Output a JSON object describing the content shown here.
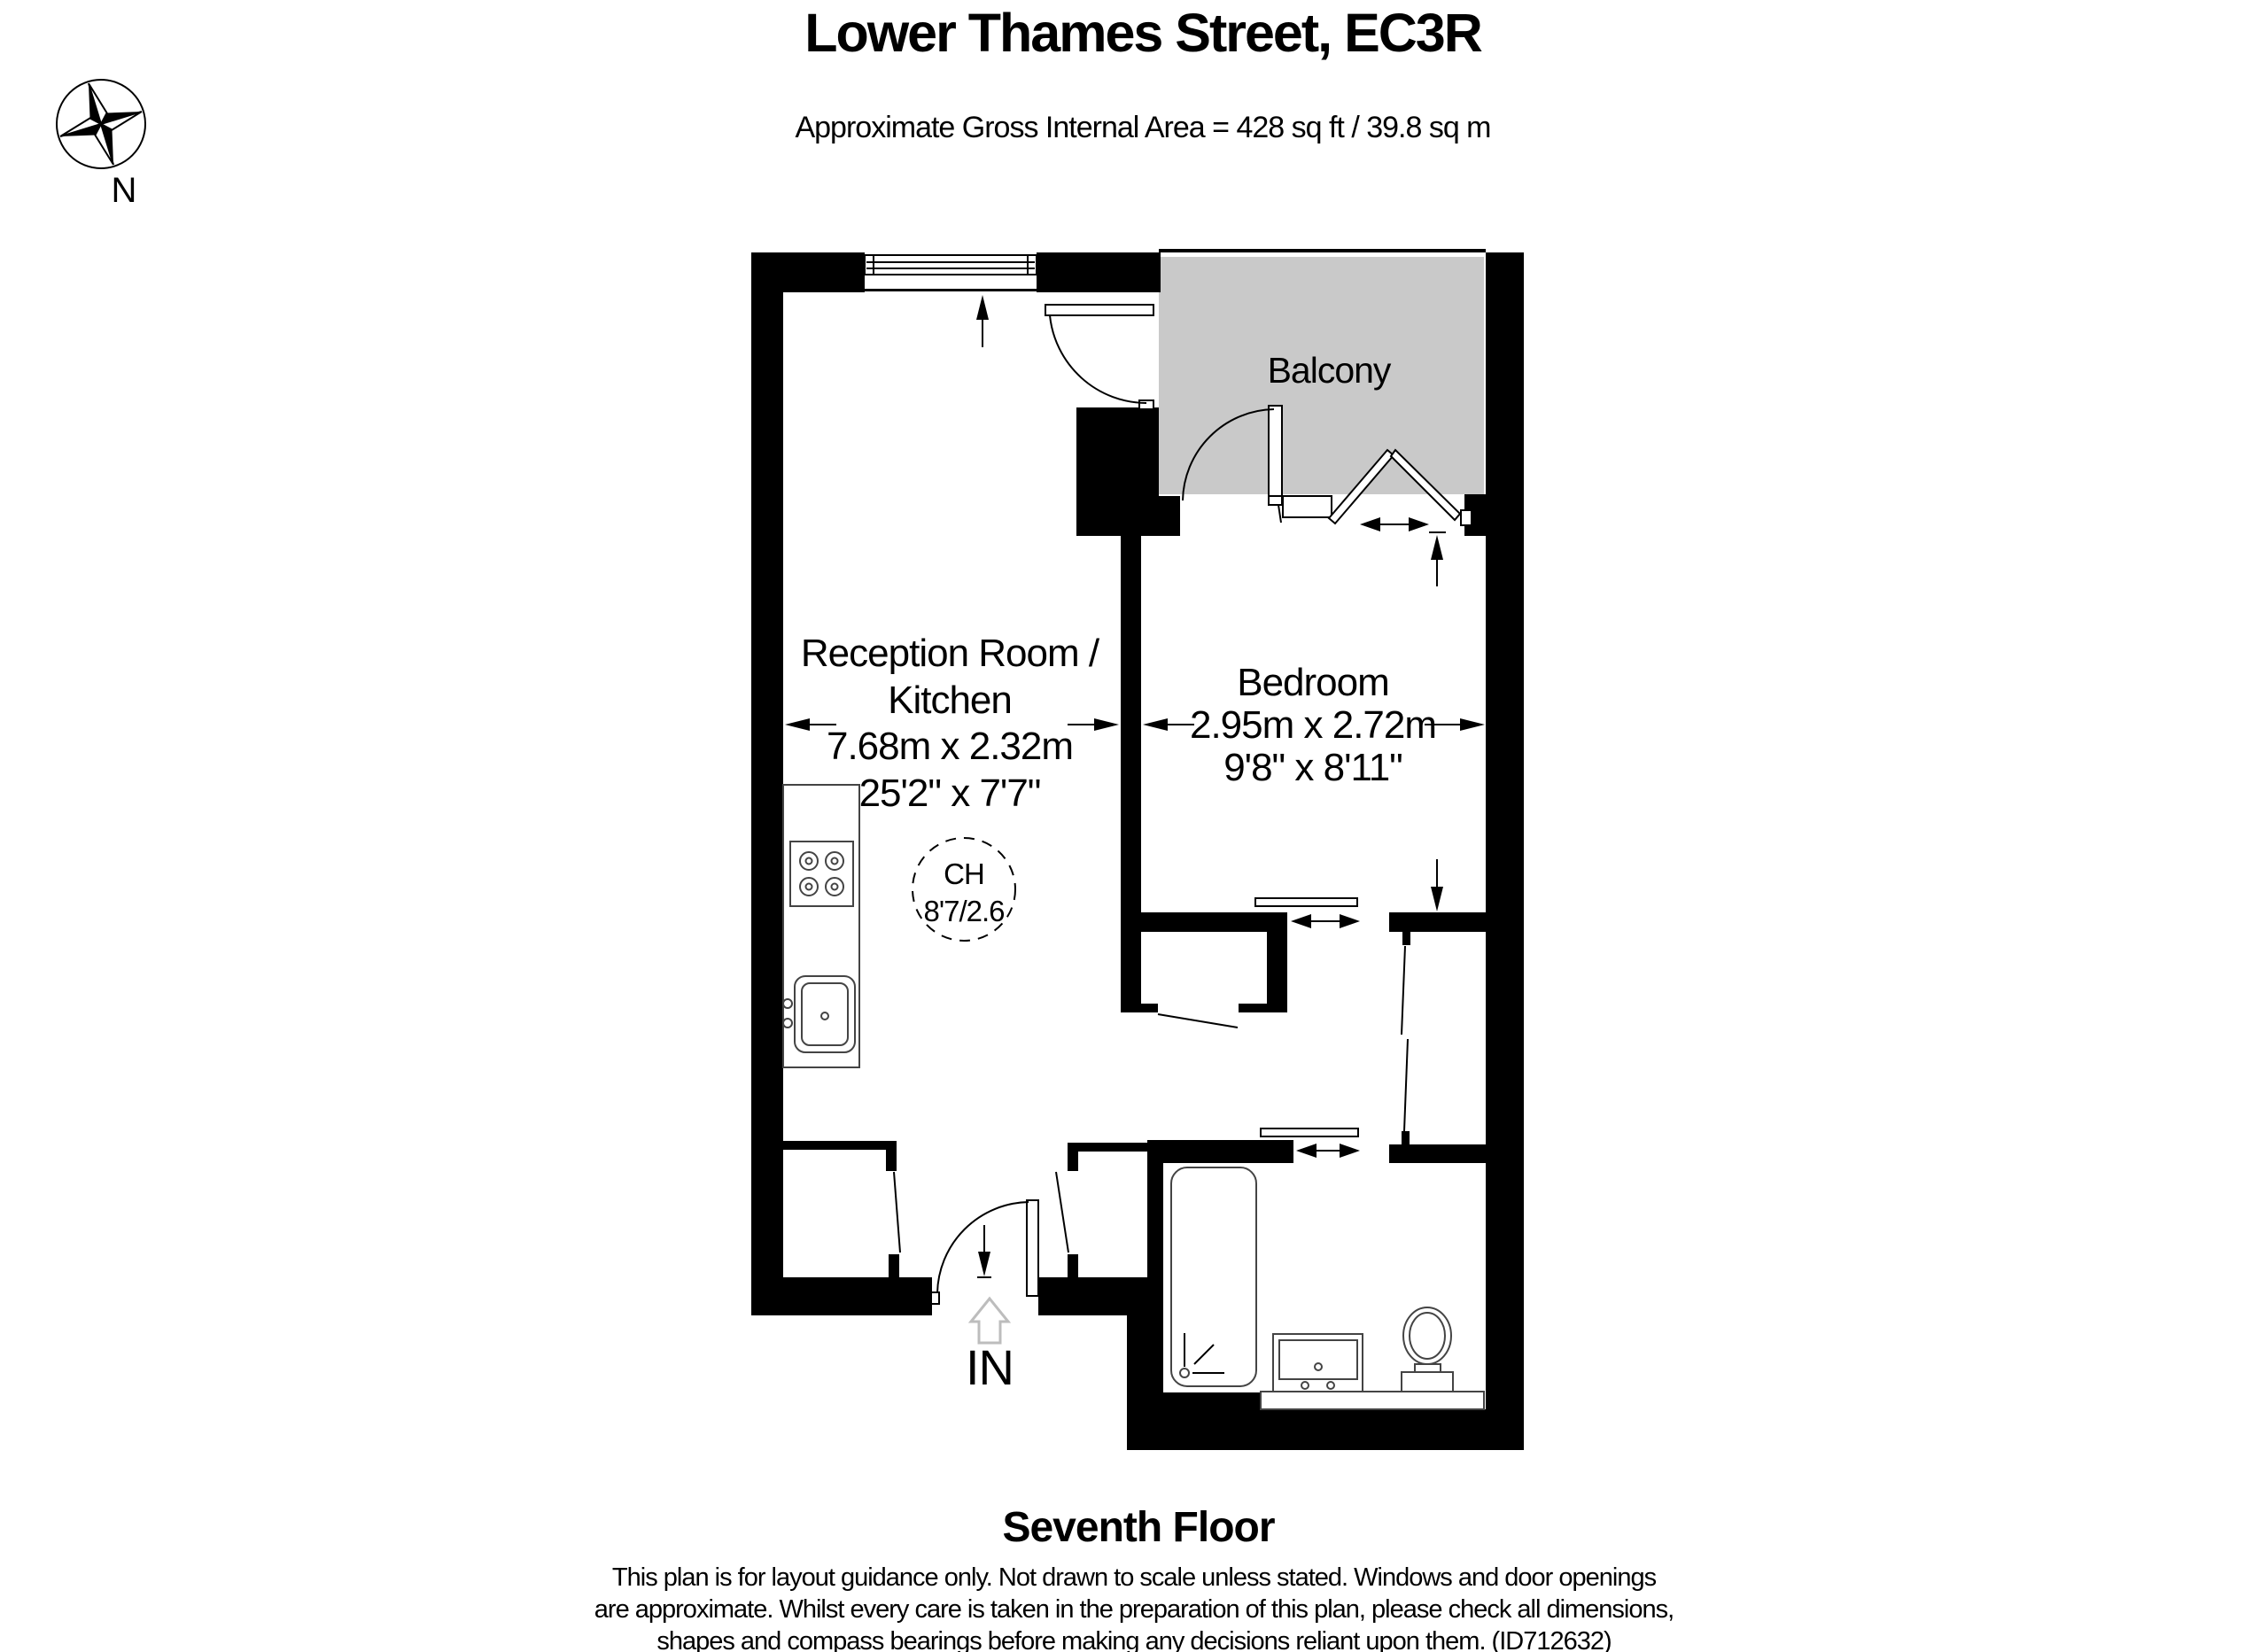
{
  "header": {
    "title": "Lower Thames Street, EC3R",
    "area_line": "Approximate Gross Internal Area = 428 sq ft / 39.8 sq m"
  },
  "compass": {
    "north_label": "N"
  },
  "plan": {
    "balcony_label": "Balcony",
    "reception": {
      "name_line1": "Reception Room /",
      "name_line2": "Kitchen",
      "metric": "7.68m x 2.32m",
      "imperial": "25'2\" x 7'7\""
    },
    "bedroom": {
      "name": "Bedroom",
      "metric": "2.95m x 2.72m",
      "imperial": "9'8\" x 8'11\""
    },
    "ceiling_height": {
      "line1": "CH",
      "line2": "8'7/2.6"
    },
    "entrance_label": "IN"
  },
  "footer": {
    "floor_label": "Seventh Floor",
    "disclaimer": [
      "This plan is for layout guidance only. Not drawn to scale unless stated. Windows and door openings",
      "are approximate. Whilst every care is taken in the preparation of this plan, please check all dimensions,",
      "shapes and compass bearings before making any decisions reliant upon them. (ID712632)"
    ]
  },
  "colors": {
    "balcony_fill": "#c9c9c9",
    "in_arrow": "#bdbdbd",
    "line": "#000000"
  }
}
